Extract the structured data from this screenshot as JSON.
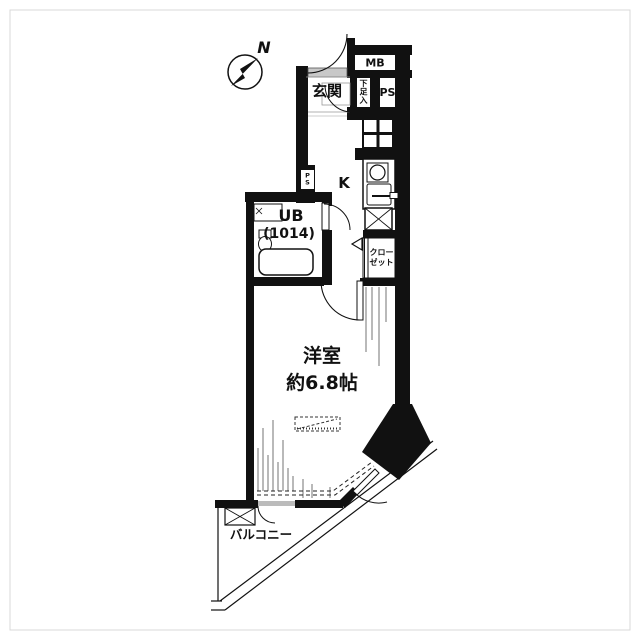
{
  "title": "apartment-floor-plan",
  "compass": {
    "north_label": "N"
  },
  "rooms": {
    "entrance": "玄関",
    "shoe_storage": "下足入",
    "meter_box": "MB",
    "pipe_space": "PS",
    "pipe_space_small": "PS",
    "kitchen": "K",
    "unit_bath_line1": "UB",
    "unit_bath_line2": "(1014)",
    "closet_line1": "クロー",
    "closet_line2": "ゼット",
    "main_room_line1": "洋室",
    "main_room_line2": "約6.8帖",
    "balcony": "バルコニー"
  },
  "colors": {
    "wall": "#111111",
    "door_leaf": "#c8c8c8",
    "window_sash": "#bbbbbb",
    "hatch": "#8a8a8a",
    "frame": "#d9d9d9"
  }
}
